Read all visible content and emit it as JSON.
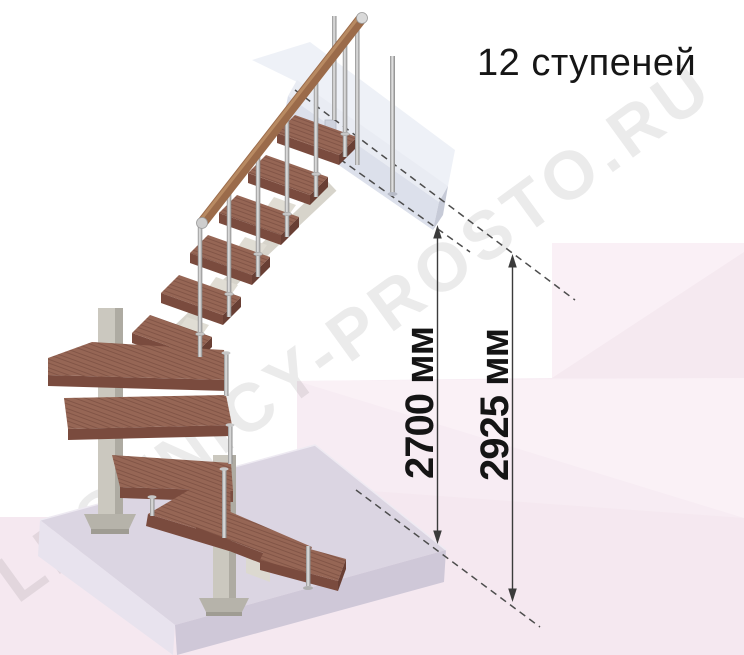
{
  "title": "12 ступеней",
  "watermark": "LESTNICY-PROSTO.RU",
  "dimensions": {
    "ceiling_height": "2700 мм",
    "total_height": "2925 мм"
  },
  "colors": {
    "wood": "#966655",
    "wood_front": "#7a4b3e",
    "wood_end": "#693f34",
    "handrail": "#9b6b4a",
    "metal": "#bdbdbd",
    "column": "#cbc8bf",
    "platform": "#dbd5e2",
    "floor_slab": "#dce0eb",
    "background_pink": "#f7ecf3",
    "dimension_line": "#3b3b3b",
    "text": "#151515"
  }
}
